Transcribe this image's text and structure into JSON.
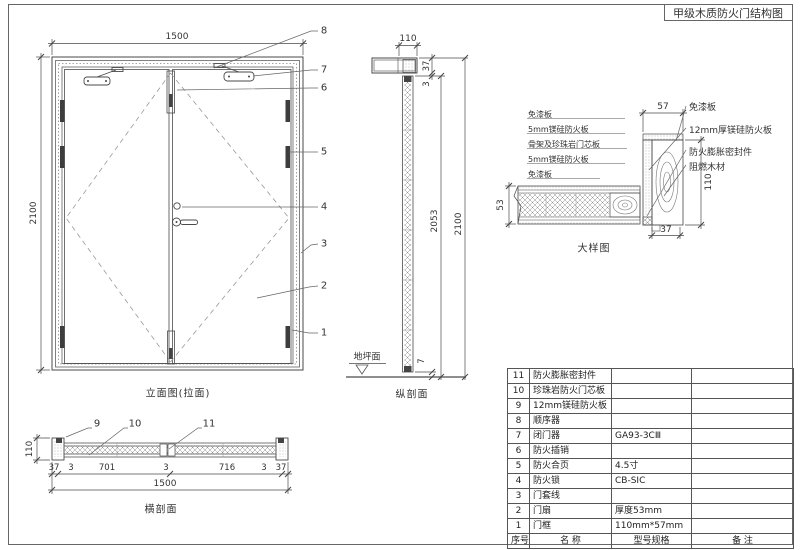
{
  "title": "甲级木质防火门结构图",
  "colors": {
    "line": "#4a4a4a",
    "text": "#333333",
    "background": "#ffffff"
  },
  "elevation": {
    "caption": "立面图(拉面)",
    "dim_width": "1500",
    "dim_height": "2100",
    "callouts": [
      "8",
      "7",
      "6",
      "5",
      "4",
      "3",
      "2",
      "1"
    ]
  },
  "vertical_section": {
    "caption": "纵剖面",
    "ground_label": "地坪面",
    "dim_frame_depth": "110",
    "dim_head_height": "37",
    "dim_top_gap": "3",
    "dim_leaf_height": "2053",
    "dim_total_height": "2100",
    "dim_bottom_gap": "7"
  },
  "detail": {
    "caption": "大样图",
    "left_labels": [
      "免漆板",
      "5mm镁硅防火板",
      "骨架及珍珠岩门芯板",
      "5mm镁硅防火板",
      "免漆板"
    ],
    "right_labels": [
      "免漆板",
      "12mm厚镁硅防火板",
      "防火膨胀密封件",
      "阻燃木材"
    ],
    "dim_frame_width": "57",
    "dim_frame_depth": "110",
    "dim_rebate": "37",
    "dim_leaf_thickness": "53"
  },
  "horizontal_section": {
    "caption": "横剖面",
    "callouts": [
      "9",
      "10",
      "11"
    ],
    "dim_frame_depth": "110",
    "dim_chain": [
      "37",
      "3",
      "701",
      "3",
      "716",
      "3",
      "37"
    ],
    "dim_total": "1500"
  },
  "parts_table": {
    "headers": [
      "序号",
      "名  称",
      "型号规格",
      "备  注"
    ],
    "rows": [
      {
        "no": "11",
        "name": "防火膨胀密封件",
        "spec": "",
        "remark": ""
      },
      {
        "no": "10",
        "name": "珍珠岩防火门芯板",
        "spec": "",
        "remark": ""
      },
      {
        "no": "9",
        "name": "12mm镁硅防火板",
        "spec": "",
        "remark": ""
      },
      {
        "no": "8",
        "name": "顺序器",
        "spec": "",
        "remark": ""
      },
      {
        "no": "7",
        "name": "闭门器",
        "spec": "GA93-3CⅢ",
        "remark": ""
      },
      {
        "no": "6",
        "name": "防火插销",
        "spec": "",
        "remark": ""
      },
      {
        "no": "5",
        "name": "防火合页",
        "spec": "4.5寸",
        "remark": ""
      },
      {
        "no": "4",
        "name": "防火锁",
        "spec": "CB-SIC",
        "remark": ""
      },
      {
        "no": "3",
        "name": "门套线",
        "spec": "",
        "remark": ""
      },
      {
        "no": "2",
        "name": "门扇",
        "spec": "厚度53mm",
        "remark": ""
      },
      {
        "no": "1",
        "name": "门框",
        "spec": "110mm*57mm",
        "remark": ""
      }
    ]
  }
}
